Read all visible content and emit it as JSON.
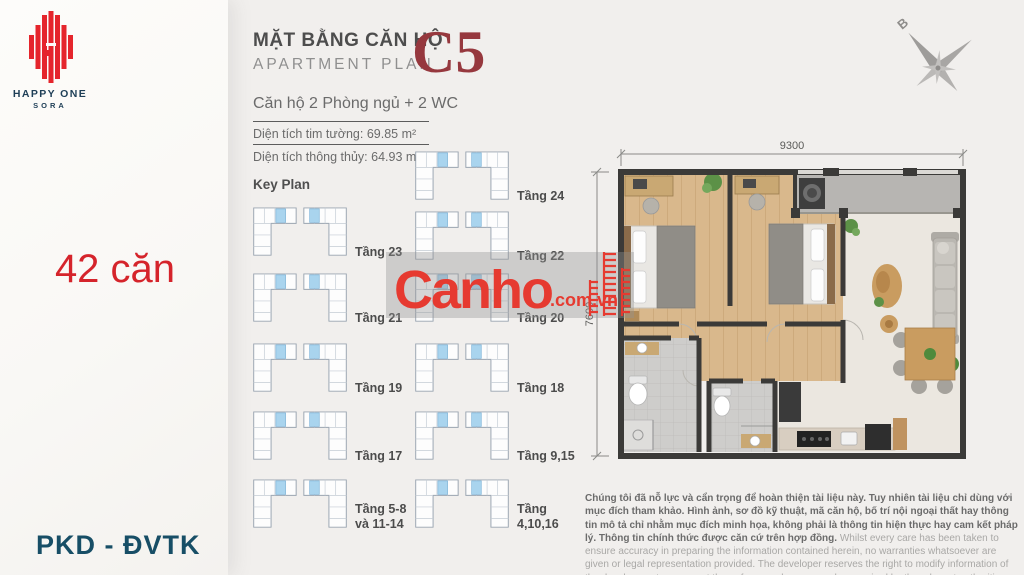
{
  "brand": {
    "logo_title": "HAPPY ONE",
    "logo_subtitle": "SORA"
  },
  "left_panel": {
    "units_count": "42 căn",
    "footer_label": "PKD - ĐVTK"
  },
  "header": {
    "title_vi": "MẶT BẰNG CĂN HỘ",
    "title_en": "APARTMENT  PLAN",
    "unit_code": "C5"
  },
  "specs": {
    "layout_line": "Căn hộ 2 Phòng ngủ + 2 WC",
    "gross_area_line": "Diện tích tim tường: 69.85 m²",
    "net_area_line": "Diện tích thông thủy: 64.93 m²"
  },
  "key_plan": {
    "label": "Key Plan",
    "floors": [
      {
        "label": "Tầng 24"
      },
      {
        "label": "Tầng 23"
      },
      {
        "label": "Tầng 22"
      },
      {
        "label": "Tầng 21"
      },
      {
        "label": "Tầng 20"
      },
      {
        "label": "Tầng 19"
      },
      {
        "label": "Tầng 18"
      },
      {
        "label": "Tầng 17"
      },
      {
        "label": "Tầng 9,15"
      },
      {
        "label": "Tầng 5-8 và 11-14"
      },
      {
        "label": "Tầng 4,10,16"
      }
    ]
  },
  "compass": {
    "north_label": "B"
  },
  "floor_plan": {
    "width_dim": "9300",
    "height_dim": "7600"
  },
  "watermark": {
    "brand": "Canho",
    "suffix": ".com.vn"
  },
  "disclaimer": {
    "vi": "Chúng tôi đã nỗ lực và cẩn trọng để hoàn thiện tài liệu này. Tuy nhiên tài liệu chỉ dùng với mục đích tham khảo. Hình ảnh, sơ đồ kỹ thuật, mã căn hộ, bố trí nội ngoại thất hay thông tin mô tả chỉ nhằm mục đích minh họa, không phải là thông tin hiện thực hay cam kết pháp lý. Thông tin chính thức được căn cứ trên hợp đồng.",
    "en": "Whilst every care has been taken to ensure accuracy in preparing the information contained herein, no warranties whatsoever are given or legal representation provided. The developer reserves the right to modify information of the development or any part thereof as may be approved or required by the relevant authorities."
  },
  "colors": {
    "accent_red": "#d5242b",
    "unit_code_red": "#96383e",
    "navy": "#1e3e56",
    "highlight_blue": "#a9d4ee"
  }
}
